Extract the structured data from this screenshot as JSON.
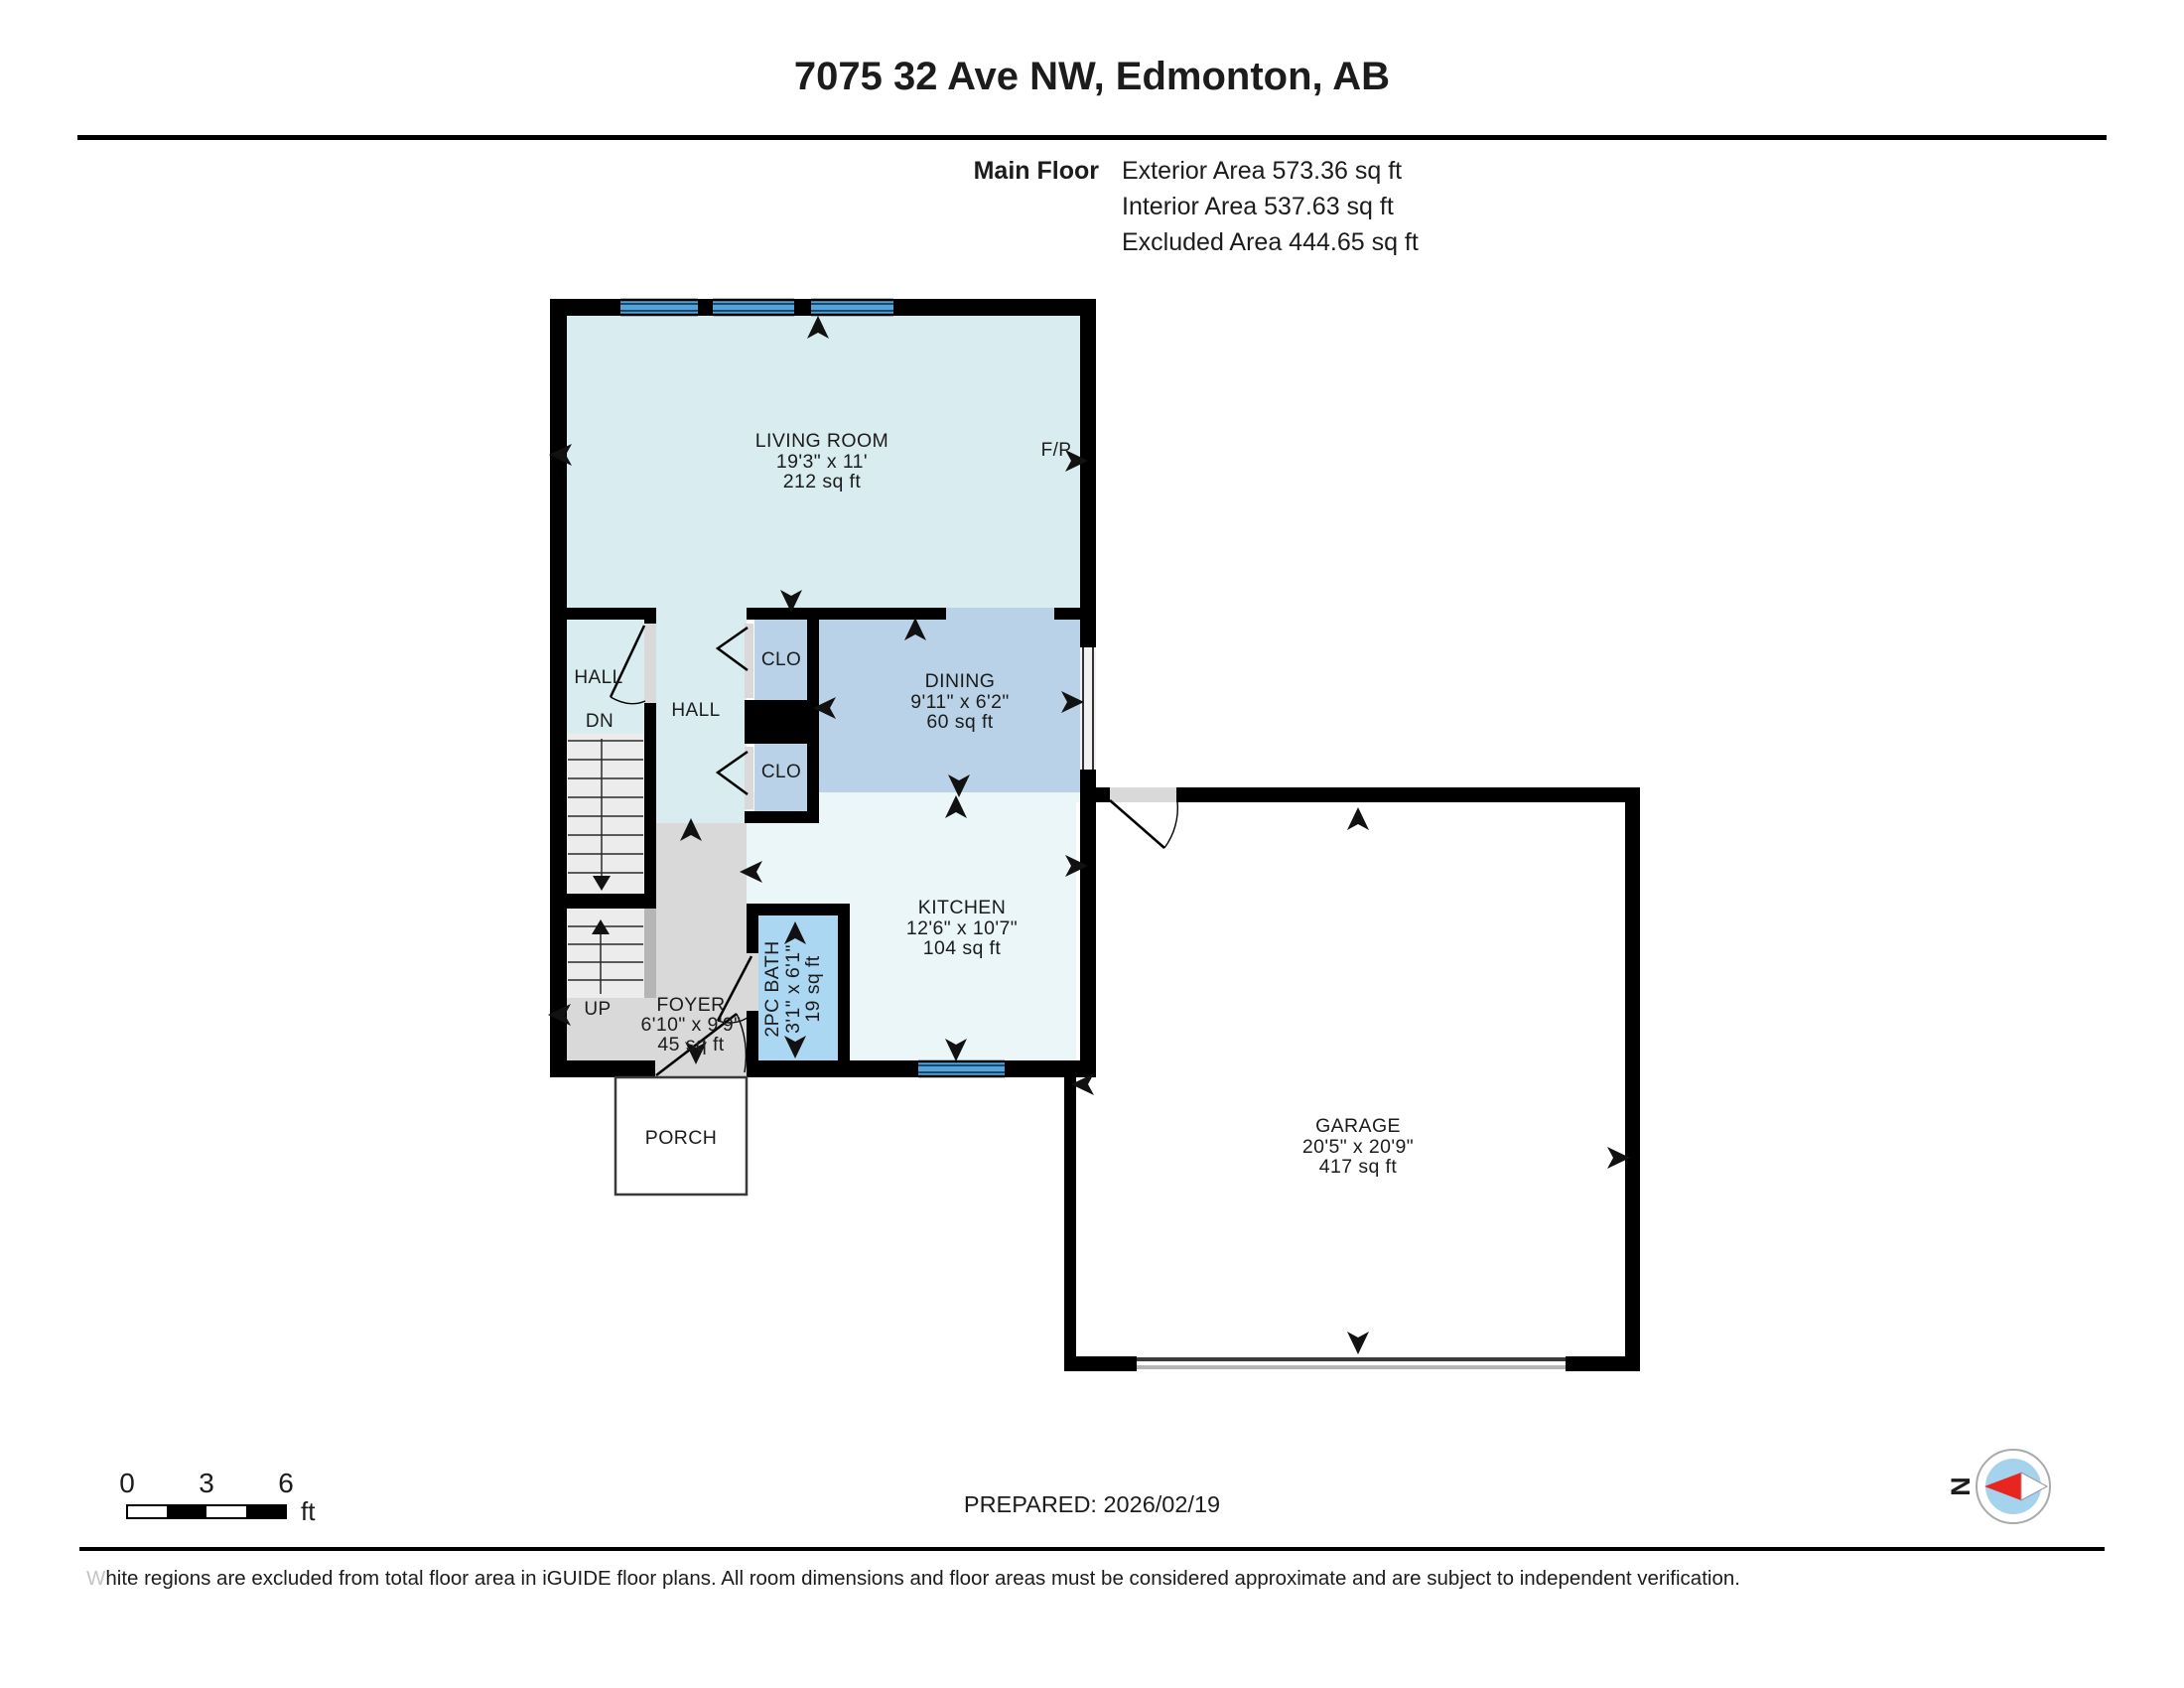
{
  "title": "7075 32 Ave NW, Edmonton, AB",
  "floor_summary": {
    "label": "Main Floor",
    "exterior": "Exterior Area 573.36 sq ft",
    "interior": "Interior Area 537.63 sq ft",
    "excluded": "Excluded Area 444.65 sq ft"
  },
  "rooms": {
    "living": {
      "name": "LIVING ROOM",
      "dims": "19'3\" x 11'",
      "area": "212 sq ft"
    },
    "dining": {
      "name": "DINING",
      "dims": "9'11\" x 6'2\"",
      "area": "60 sq ft"
    },
    "kitchen": {
      "name": "KITCHEN",
      "dims": "12'6\" x 10'7\"",
      "area": "104 sq ft"
    },
    "foyer": {
      "name": "FOYER",
      "dims": "6'10\" x 9'9\"",
      "area": "45 sq ft"
    },
    "bath": {
      "name": "2PC BATH",
      "dims": "3'1\" x 6'1\"",
      "area": "19 sq ft"
    },
    "garage": {
      "name": "GARAGE",
      "dims": "20'5\" x 20'9\"",
      "area": "417 sq ft"
    },
    "porch": {
      "name": "PORCH"
    }
  },
  "labels": {
    "hall_left": "HALL",
    "hall": "HALL",
    "dn": "DN",
    "up": "UP",
    "clo_top": "CLO",
    "clo_bottom": "CLO",
    "fireplace": "F/P"
  },
  "scale_bar": {
    "tick0": "0",
    "tick3": "3",
    "tick6": "6",
    "unit": "ft"
  },
  "prepared": "PREPARED: 2026/02/19",
  "compass": {
    "north_label": "N"
  },
  "footer": {
    "first_letter": "W",
    "rest": "hite regions are excluded from total floor area in iGUIDE floor plans. All room dimensions and floor areas must be considered approximate and are subject to independent verification."
  },
  "colors": {
    "wall": "#000000",
    "living_hall": "#d9edf0",
    "kitchen": "#eaf6f8",
    "dining_closet": "#b9d2e7",
    "bath": "#abd7f2",
    "floor_gray": "#d9d9d9",
    "stair_fill": "#ececec",
    "handrail_gray": "#b5b5b5",
    "window_blue": "#56a3d8",
    "excluded_white": "#ffffff",
    "compass_red": "#e8251f",
    "compass_blue": "#a5d2ec"
  }
}
